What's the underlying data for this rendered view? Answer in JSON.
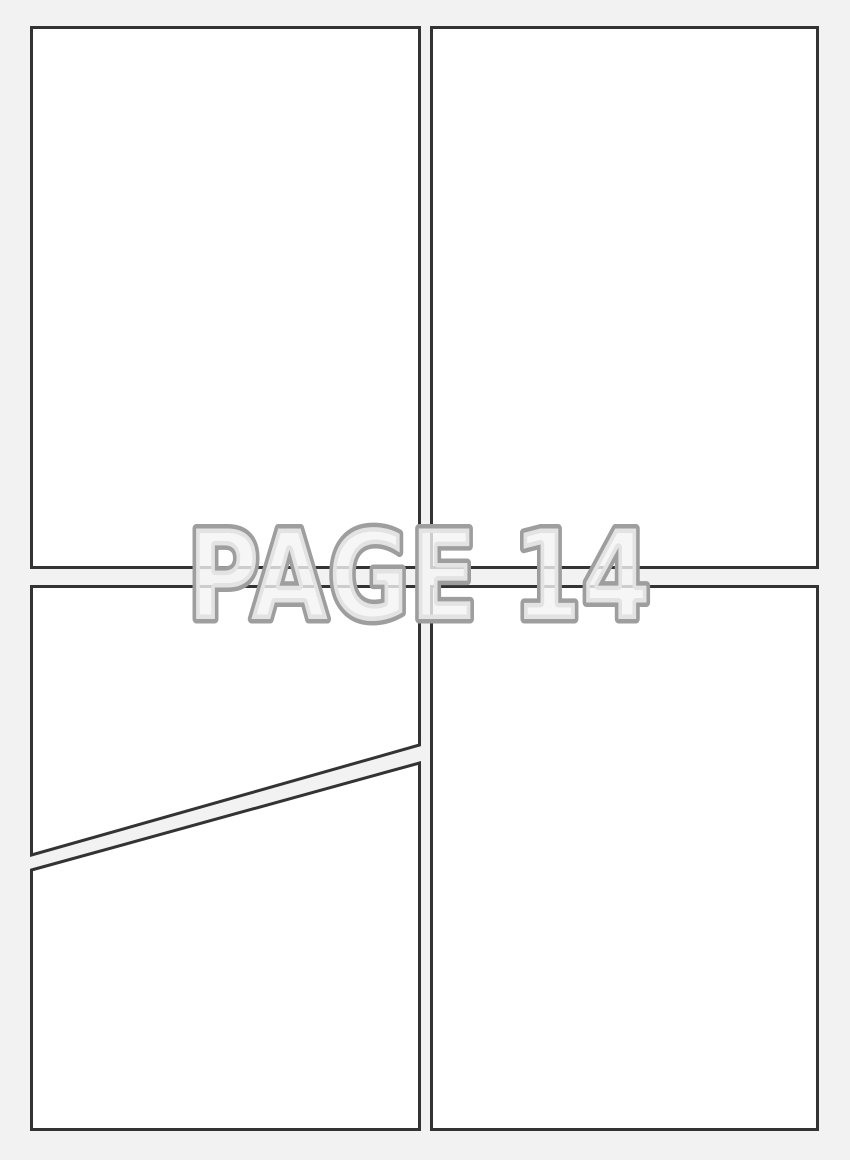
{
  "page": {
    "label": "PAGE 14",
    "colors": {
      "background": "#f2f2f3",
      "panel_fill": "#ffffff",
      "panel_border": "#333333",
      "label_outline": "#9e9e9e",
      "label_fill": "#f4f4f5"
    }
  },
  "panels": [
    {
      "name": "top-left"
    },
    {
      "name": "top-right"
    },
    {
      "name": "bottom-left-upper-diagonal"
    },
    {
      "name": "bottom-left-lower-diagonal"
    },
    {
      "name": "bottom-right"
    }
  ]
}
